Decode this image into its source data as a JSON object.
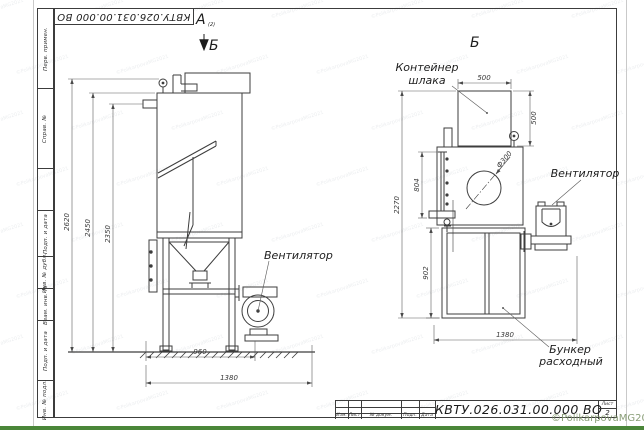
{
  "sheet": {
    "doc_number": "КВТУ.026.031.00.000  ВО",
    "sheet_word": "Лист",
    "sheet_number": "2"
  },
  "frame": {
    "fields": [
      "Перв. примен.",
      "Справ. №",
      "Подп. и дата",
      "Инв. № дубл.",
      "Взам. инв. №",
      "Подп. и дата",
      "Инв. № подл."
    ]
  },
  "title_block": {
    "columns": [
      "Изм.",
      "Лист",
      "№ докум.",
      "Подп.",
      "Дата"
    ]
  },
  "views": {
    "a": "А",
    "a_sub": "(2)",
    "b_arrow": "Б",
    "b": "Б"
  },
  "labels": {
    "fan_left": "Вентилятор",
    "fan_right": "Вентилятор",
    "container_l1": "Контейнер",
    "container_l2": "шлака",
    "hopper_l1": "Бункер",
    "hopper_l2": "расходный"
  },
  "dims": {
    "h2620": "2620",
    "h2450": "2450",
    "h2350": "2350",
    "w960": "960",
    "w1380_left": "1380",
    "c500w": "500",
    "c500h": "500",
    "dia300": "Ф300",
    "h804": "804",
    "h902": "902",
    "h2270": "2270",
    "w1380_right": "1380"
  },
  "watermarks": {
    "corner": "©PolikarpovaMG2021",
    "tile": "©PolikarpovaMG2021"
  },
  "colors": {
    "line": "#3d3d3d",
    "dim_line": "#5a5a5a",
    "green_bar": "#4a8639",
    "watermark_green": "#7d9469"
  }
}
